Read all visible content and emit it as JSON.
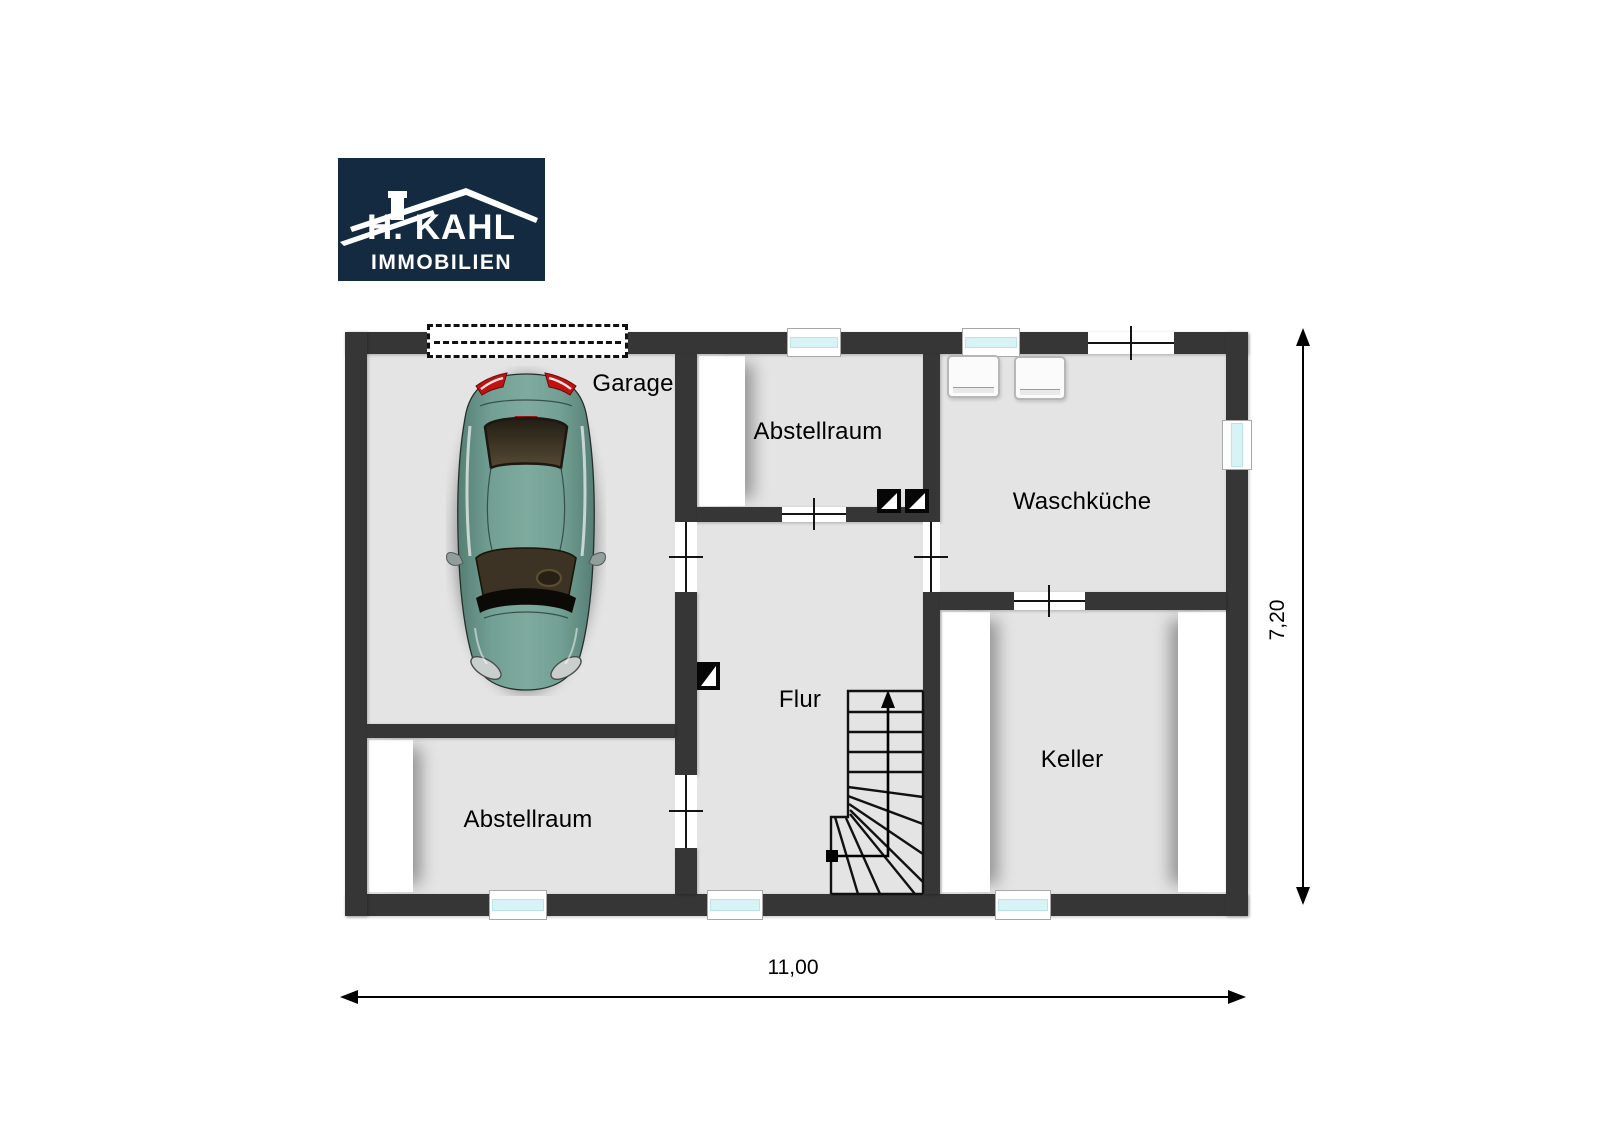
{
  "logo": {
    "brand_line1": "H. KAHL",
    "brand_line2": "IMMOBILIEN",
    "bg_color": "#142a40",
    "roof_color": "#ffffff"
  },
  "plan": {
    "rooms": [
      {
        "id": "garage",
        "label": "Garage"
      },
      {
        "id": "abstellraum_top",
        "label": "Abstellraum"
      },
      {
        "id": "waschkueche",
        "label": "Waschküche"
      },
      {
        "id": "flur",
        "label": "Flur"
      },
      {
        "id": "keller",
        "label": "Keller"
      },
      {
        "id": "abstellraum_bottom",
        "label": "Abstellraum"
      }
    ],
    "dimensions": {
      "width_label": "11,00",
      "height_label": "7,20"
    },
    "colors": {
      "wall": "#363636",
      "floor": "#e4e4e4",
      "window_glass": "#d7f3f5",
      "door_opening": "#ffffff",
      "dimension_line": "#000000",
      "car_body": "#6f9b90",
      "logo_background": "#142a40"
    }
  }
}
